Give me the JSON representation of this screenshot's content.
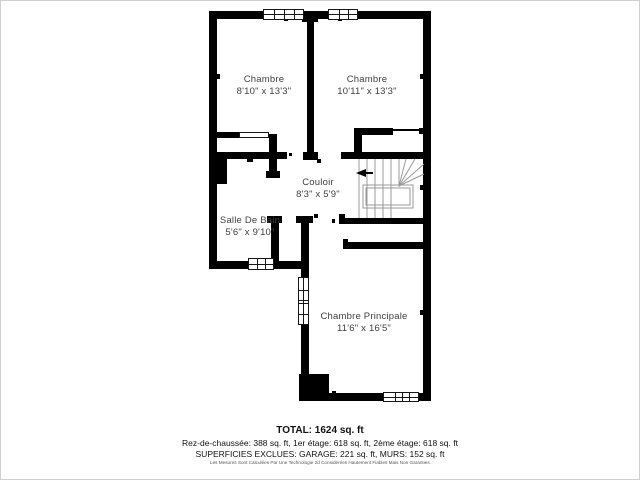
{
  "rooms": [
    {
      "name": "Chambre",
      "dims": "8'10\" x 13'3\""
    },
    {
      "name": "Chambre",
      "dims": "10'11\" x 13'3\""
    },
    {
      "name": "Couloir",
      "dims": "8'3\" x 5'9\""
    },
    {
      "name": "Salle De Bain",
      "dims": "5'6\" x 9'10\""
    },
    {
      "name": "Chambre Principale",
      "dims": "11'6\" x 16'5\""
    }
  ],
  "footer": {
    "total": "TOTAL: 1624 sq. ft",
    "floors": "Rez-de-chaussée: 388 sq. ft, 1er étage: 618 sq. ft, 2ème étage: 618 sq. ft",
    "exclusions": "SUPERFICIES EXCLUES: GARAGE: 221 sq. ft, MURS: 152 sq. ft",
    "disclaimer": "Les Mesures Sont Calculées Par Une Technologie 2d Considérées Hautement Fiables Mais Non Garanties."
  },
  "colors": {
    "wall": "#000000",
    "stair_lines": "#999999",
    "label_text": "#3f3f3f",
    "page_border": "#cfcfcf"
  }
}
